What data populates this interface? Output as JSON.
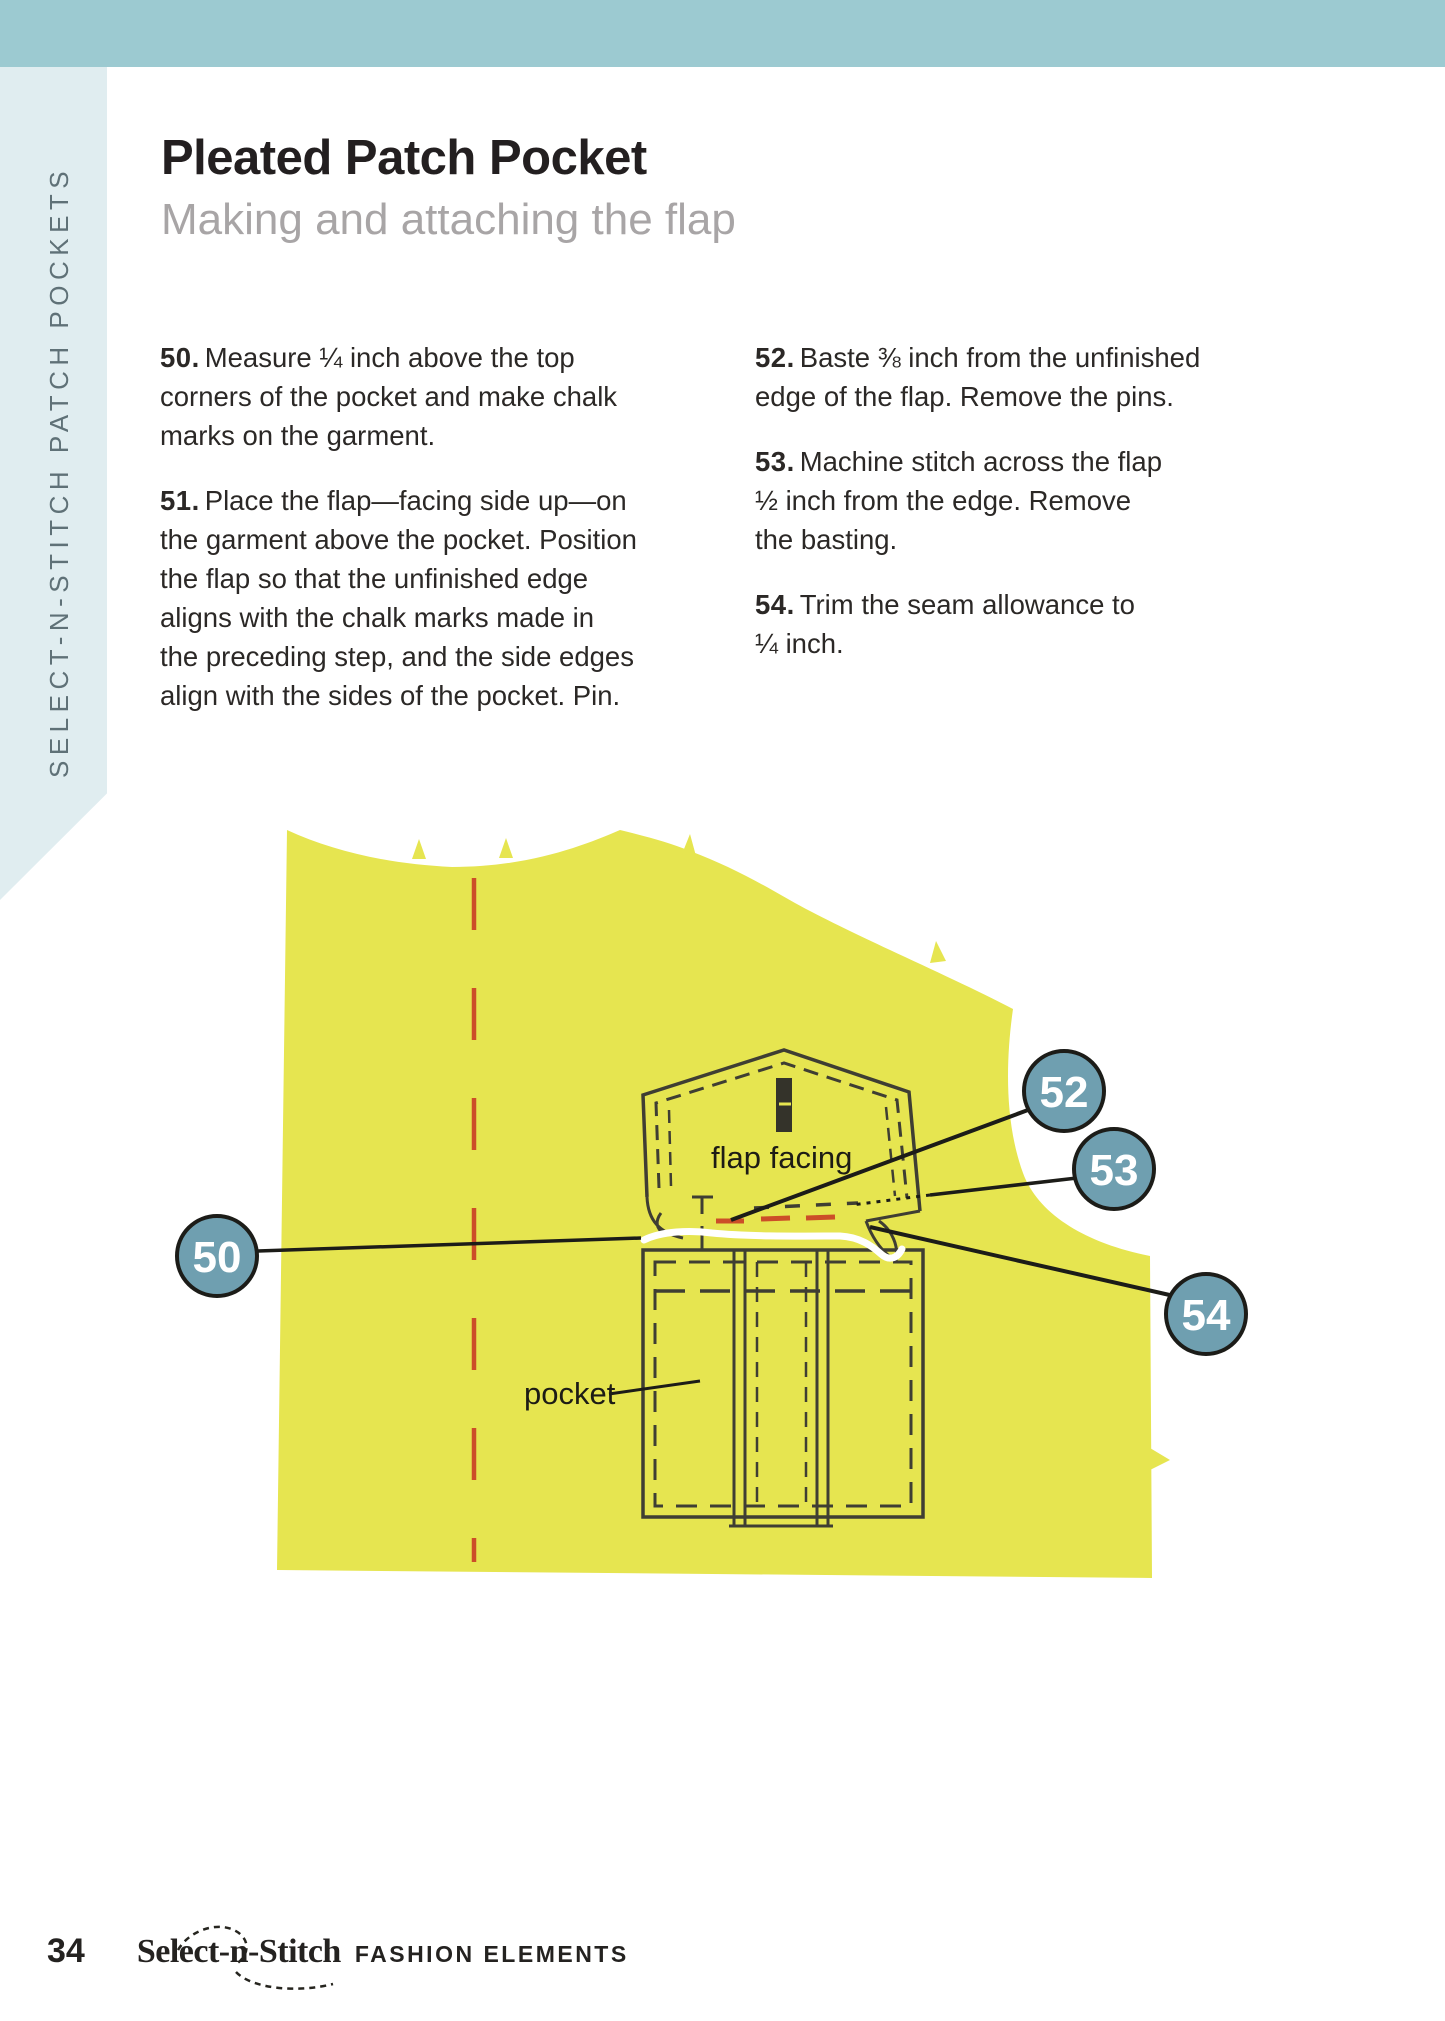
{
  "top_bar": {
    "color": "#9ccad1"
  },
  "sidebar": {
    "label": "SELECT-N-STITCH PATCH POCKETS",
    "bg": "#e0edf0",
    "text_color": "#5f7177"
  },
  "header": {
    "title": "Pleated Patch Pocket",
    "subtitle": "Making and attaching the flap"
  },
  "instructions": {
    "col1": [
      {
        "num": "50.",
        "text": "Measure ¼ inch above the top\ncorners of the pocket and make chalk\nmarks on the garment."
      },
      {
        "num": "51.",
        "text": "Place the flap—facing side up—on\nthe garment above the pocket. Position\nthe flap so that the unfinished edge\naligns with the chalk marks made in\nthe preceding step, and the side edges\nalign with the sides of the pocket. Pin."
      }
    ],
    "col2": [
      {
        "num": "52.",
        "text": "Baste ⅜ inch from the unfinished\nedge of the flap. Remove the pins."
      },
      {
        "num": "53.",
        "text": "Machine stitch across the flap\n½ inch from the edge. Remove\nthe basting."
      },
      {
        "num": "54.",
        "text": "Trim the seam allowance to\n¼ inch."
      }
    ]
  },
  "diagram": {
    "labels": {
      "flap_facing": "flap facing",
      "pocket": "pocket"
    },
    "callouts": [
      {
        "n": "50"
      },
      {
        "n": "52"
      },
      {
        "n": "53"
      },
      {
        "n": "54"
      }
    ],
    "colors": {
      "fabric": "#e6e550",
      "callout_fill": "#6f9fb0",
      "ink": "#3f3e33",
      "red_basting": "#cc4e28",
      "stitch_white": "#ffffff"
    }
  },
  "footer": {
    "page_number": "34",
    "brand": "Select-n-Stitch",
    "brand_suffix": "FASHION ELEMENTS"
  }
}
